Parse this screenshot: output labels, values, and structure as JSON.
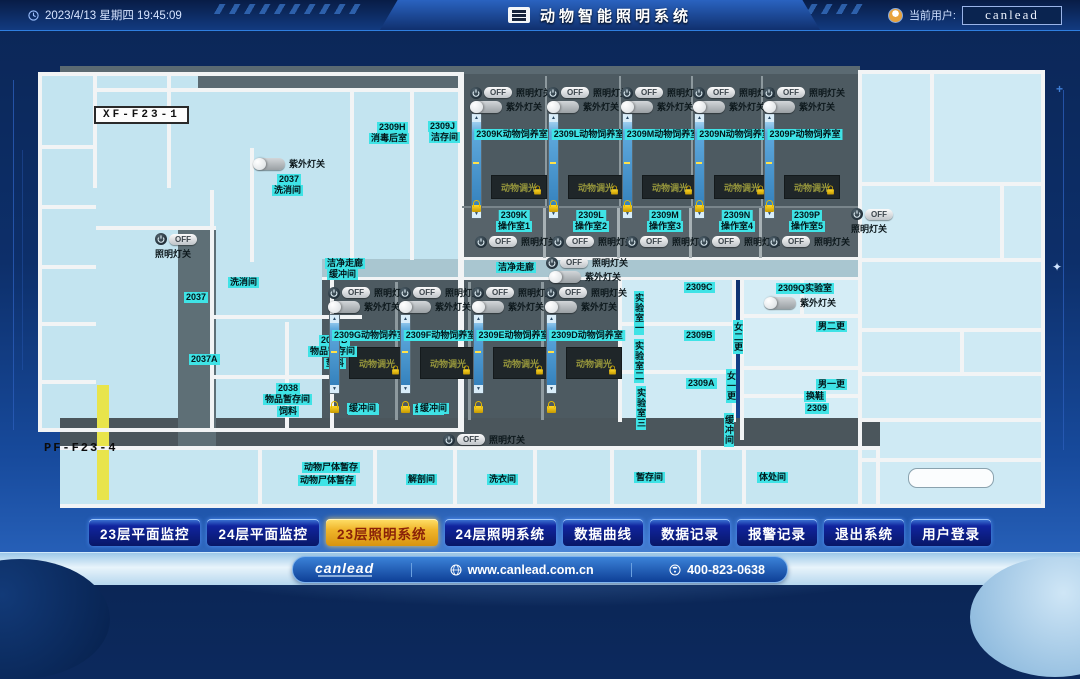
{
  "header": {
    "time": "2023/4/13 星期四 19:45:09",
    "title": "动物智能照明系统",
    "user_label": "当前用户:",
    "username": "canlead"
  },
  "nav": {
    "items": [
      {
        "label": "23层平面监控",
        "active": false
      },
      {
        "label": "24层平面监控",
        "active": false
      },
      {
        "label": "23层照明系统",
        "active": true
      },
      {
        "label": "24层照明系统",
        "active": false
      },
      {
        "label": "数据曲线",
        "active": false
      },
      {
        "label": "数据记录",
        "active": false
      },
      {
        "label": "报警记录",
        "active": false
      },
      {
        "label": "退出系统",
        "active": false
      },
      {
        "label": "用户登录",
        "active": false
      }
    ]
  },
  "footer": {
    "brand": "canlead",
    "website": "www.canlead.com.cn",
    "phone": "400-823-0638"
  },
  "plan": {
    "strings": {
      "off": "OFF",
      "light_switch": "照明灯关",
      "uv_switch": "紫外灯关",
      "dimmer": "动物调光"
    },
    "area_tags": [
      {
        "text": "XF-F23-1",
        "x": 94,
        "y": 76,
        "style": "box"
      },
      {
        "text": "PF-F23-4",
        "x": 44,
        "y": 411,
        "style": "plain"
      }
    ],
    "tags": [
      {
        "t": "2309H",
        "x": 377,
        "y": 92
      },
      {
        "t": "消毒后室",
        "x": 369,
        "y": 103
      },
      {
        "t": "2309J",
        "x": 428,
        "y": 91
      },
      {
        "t": "洁存间",
        "x": 429,
        "y": 102
      },
      {
        "t": "2037",
        "x": 277,
        "y": 144
      },
      {
        "t": "洗消间",
        "x": 272,
        "y": 155
      },
      {
        "t": "洗消间",
        "x": 228,
        "y": 247
      },
      {
        "t": "2037",
        "x": 184,
        "y": 262
      },
      {
        "t": "2037A",
        "x": 189,
        "y": 324
      },
      {
        "t": "2037B",
        "x": 319,
        "y": 305
      },
      {
        "t": "物品暂存间",
        "x": 308,
        "y": 316
      },
      {
        "t": "垫料",
        "x": 324,
        "y": 328
      },
      {
        "t": "2038",
        "x": 276,
        "y": 353
      },
      {
        "t": "物品暂存间",
        "x": 263,
        "y": 364
      },
      {
        "t": "饲料",
        "x": 277,
        "y": 376
      },
      {
        "t": "洁净走廊",
        "x": 325,
        "y": 228
      },
      {
        "t": "缓冲间",
        "x": 327,
        "y": 239
      },
      {
        "t": "洁净走廊",
        "x": 496,
        "y": 232
      },
      {
        "t": "缓冲间",
        "x": 348,
        "y": 374
      },
      {
        "t": "缓冲间",
        "x": 413,
        "y": 374
      },
      {
        "t": "动物尸体暂存",
        "x": 302,
        "y": 432
      },
      {
        "t": "动物尸体暂存",
        "x": 298,
        "y": 445
      },
      {
        "t": "解剖间",
        "x": 406,
        "y": 444
      },
      {
        "t": "洗衣间",
        "x": 487,
        "y": 444
      },
      {
        "t": "暂存间",
        "x": 634,
        "y": 442
      },
      {
        "t": "体处间",
        "x": 757,
        "y": 442
      },
      {
        "t": "2309C",
        "x": 684,
        "y": 252
      },
      {
        "t": "2309B",
        "x": 684,
        "y": 300
      },
      {
        "t": "2309A",
        "x": 686,
        "y": 348
      },
      {
        "t": "实验室一",
        "x": 634,
        "y": 261,
        "v": true
      },
      {
        "t": "实验室二",
        "x": 634,
        "y": 309,
        "v": true
      },
      {
        "t": "实验室三",
        "x": 636,
        "y": 356,
        "v": true
      },
      {
        "t": "2309Q实验室",
        "x": 776,
        "y": 253
      },
      {
        "t": "男二更",
        "x": 816,
        "y": 291
      },
      {
        "t": "男一更",
        "x": 816,
        "y": 349
      },
      {
        "t": "换鞋",
        "x": 804,
        "y": 361
      },
      {
        "t": "2309",
        "x": 805,
        "y": 373
      },
      {
        "t": "女二更",
        "x": 733,
        "y": 290,
        "v": true
      },
      {
        "t": "女一更",
        "x": 726,
        "y": 339,
        "v": true
      },
      {
        "t": "缓冲间",
        "x": 724,
        "y": 383,
        "v": true
      }
    ],
    "switches": [
      {
        "x": 155,
        "y": 203,
        "type": "power",
        "label": "照明灯关",
        "label_pos": "below"
      },
      {
        "x": 253,
        "y": 127,
        "type": "toggle",
        "label": "紫外灯关",
        "label_pos": "right"
      },
      {
        "x": 546,
        "y": 226,
        "type": "power",
        "label": "照明灯关",
        "label_pos": "right"
      },
      {
        "x": 549,
        "y": 240,
        "type": "toggle",
        "label": "紫外灯关",
        "label_pos": "right"
      },
      {
        "x": 443,
        "y": 403,
        "type": "power",
        "label": "照明灯关",
        "label_pos": "right"
      },
      {
        "x": 851,
        "y": 178,
        "type": "power",
        "label": "照明灯关",
        "label_pos": "below"
      },
      {
        "x": 764,
        "y": 266,
        "type": "toggle",
        "label": "紫外灯关",
        "label_pos": "right"
      }
    ],
    "room_rows": [
      {
        "off_y": 56,
        "uv_y": 70,
        "slider_y": 83,
        "slider_h": 104,
        "name_y": 99,
        "panel_y": 145,
        "panel_h": 22,
        "lock_y": 170,
        "op_code_y": 180,
        "op_name_y": 191,
        "op_off_y": 205,
        "columns": [
          {
            "x": 470,
            "room": "2309K动物饲养室",
            "op_code": "2309K",
            "op_name": "操作室1"
          },
          {
            "x": 547,
            "room": "2309L动物饲养室",
            "op_code": "2309L",
            "op_name": "操作室2"
          },
          {
            "x": 621,
            "room": "2309M动物饲养室",
            "op_code": "2309M",
            "op_name": "操作室3"
          },
          {
            "x": 693,
            "room": "2309N动物饲养室",
            "op_code": "2309N",
            "op_name": "操作室4"
          },
          {
            "x": 763,
            "room": "2309P动物饲养室",
            "op_code": "2309P",
            "op_name": "操作室5"
          }
        ]
      },
      {
        "off_y": 256,
        "uv_y": 270,
        "slider_y": 284,
        "slider_h": 78,
        "name_y": 300,
        "panel_y": 317,
        "panel_h": 30,
        "lock_y": 371,
        "buffer_y": 373,
        "columns": [
          {
            "x": 328,
            "room": "2309G动物饲养室",
            "buffer": true
          },
          {
            "x": 399,
            "room": "2309F动物饲养室",
            "buffer": true
          },
          {
            "x": 472,
            "room": "2309E动物饲养室",
            "lock_only": true
          },
          {
            "x": 545,
            "room": "2309D动物饲养室"
          }
        ]
      }
    ]
  }
}
